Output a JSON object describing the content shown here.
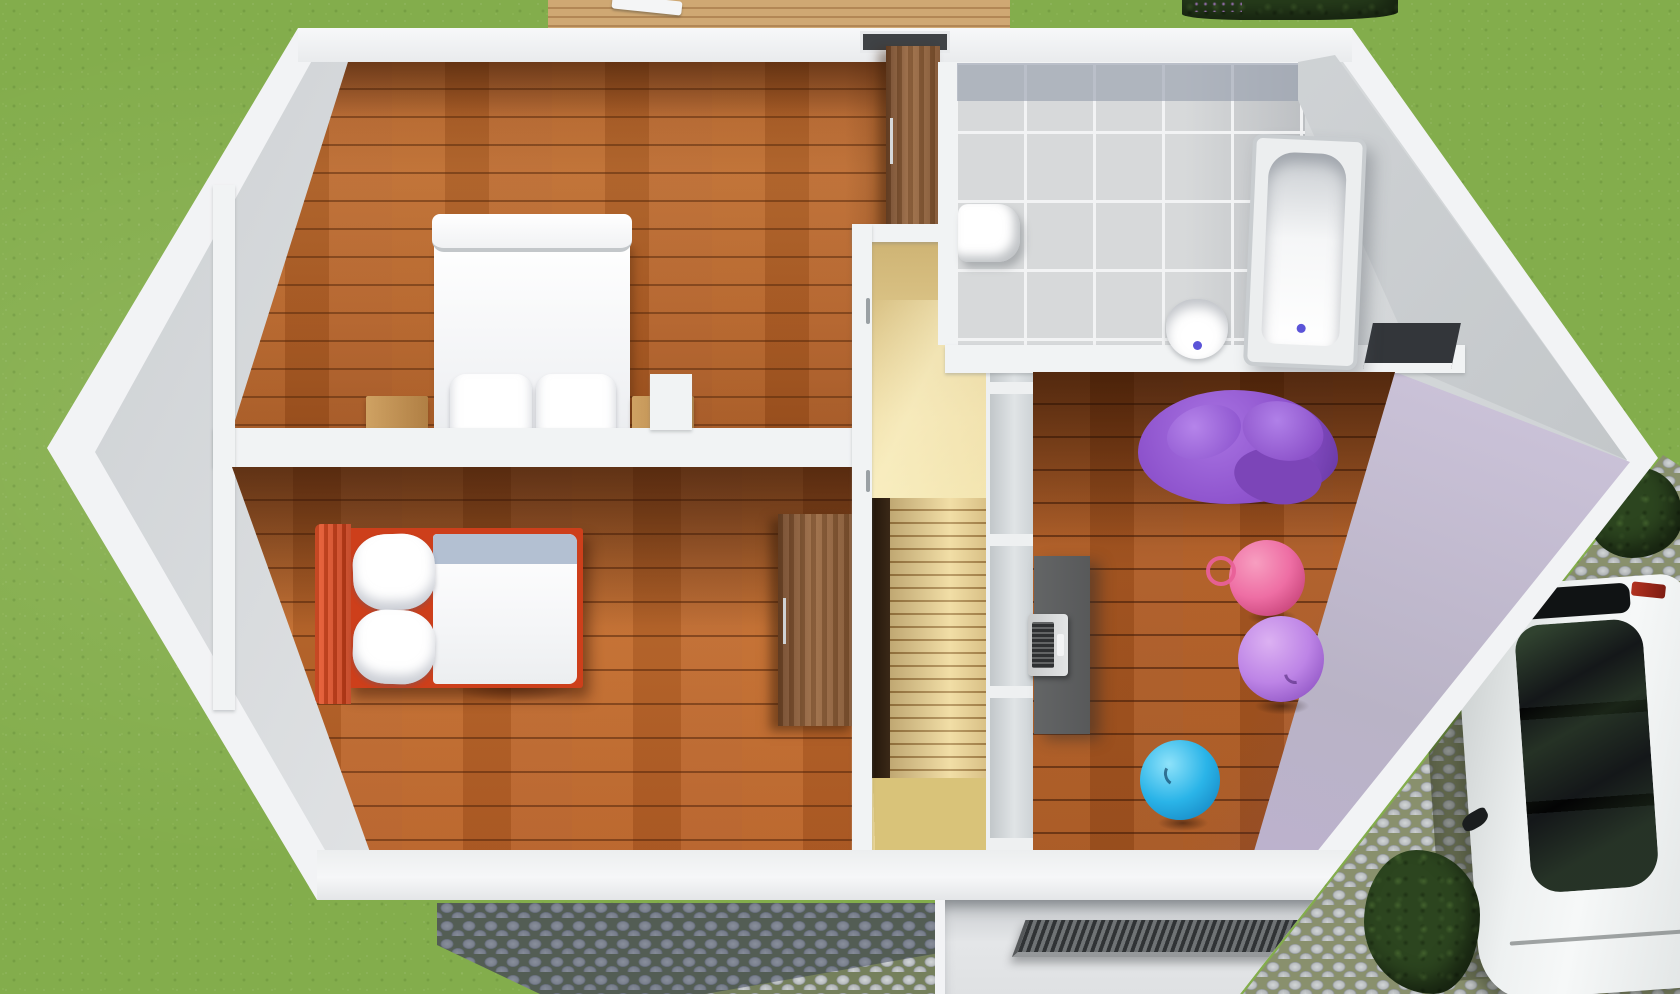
{
  "scene": {
    "type": "3d_floorplan_render",
    "view": "top-down cutaway",
    "description": "Photorealistic top-down 3D render of the upper floor of a house: two bedrooms on the left, central staircase hall, bathroom top right, playroom with gym balls on the right, lawn around the house, cobblestone patio and driveway with a parked car.",
    "labels": {
      "canvas": "Upper floor 3D floor plan render",
      "lawn": "Lawn",
      "deck": "Wooden deck",
      "deck_table": "Deck table",
      "hedge_top": "Hedge with flowers",
      "patio": "Cobblestone patio",
      "driveway": "Cobblestone driveway",
      "car": "Parked car",
      "car_glass": "Car roof glazing",
      "house": "House walls (cutaway)",
      "master_bedroom": "Master bedroom",
      "double_bed": "Double bed",
      "nightstand_left": "Left nightstand",
      "nightstand_right": "Right nightstand",
      "wardrobe": "Wardrobe",
      "roof_window": "Roof window",
      "kids_bedroom": "Second bedroom",
      "single_bed": "Single bed with red frame",
      "dresser": "Dresser",
      "hallway": "Stair hall",
      "staircase": "Staircase",
      "stair_winders": "Winder steps",
      "stairwell_void": "Stairwell void",
      "glass_partition": "Glazed stair partition",
      "bathroom": "Bathroom",
      "bathtub": "Bathtub",
      "washbasin": "Washbasin",
      "toilet": "Toilet",
      "storage_niche": "Storage niche",
      "playroom": "Playroom",
      "bean_bag": "Purple bean bag sofa",
      "desk": "Desk",
      "laptop": "Laptop",
      "ball_pink": "Pink gym ball",
      "ball_purple": "Purple gym ball",
      "ball_blue": "Blue gym ball",
      "balcony_recess": "Entrance recess",
      "vent_grate": "Ribbed grate",
      "hedge_right": "Hedge"
    },
    "colors": {
      "grass": "#83ad4c",
      "wall_white": "#f1f3f4",
      "wall_gray": "#cfd3d6",
      "tile": "#d7d9da",
      "tile_dark": "#a7aeba",
      "bed_red": "#cd3f1b",
      "duvet_fold": "#b3c0d2",
      "beanbag": "#8d52cc",
      "ball_pink": "#ee6ea4",
      "ball_purple": "#bd84e6",
      "ball_blue": "#2ab4e8",
      "desk": "#58595a",
      "cobble_grout": "#75805c",
      "bush": "#2c451f",
      "car_glass": "#141719",
      "drain_blue": "#5b54d8",
      "hall_wood": "#e8d49c",
      "stair_dark": "#30200f"
    }
  }
}
